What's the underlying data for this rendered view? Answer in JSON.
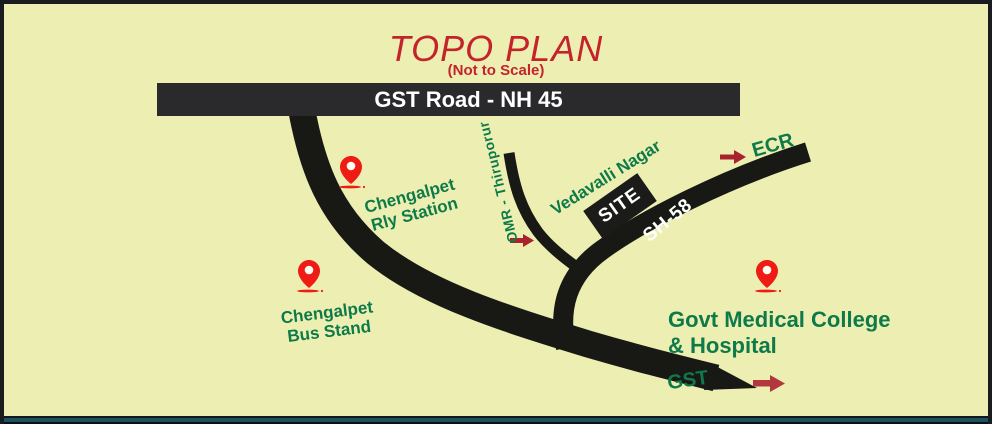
{
  "map": {
    "title": "TOPO PLAN",
    "subtitle": "(Not to Scale)",
    "gst_road_label": "GST Road - NH 45",
    "sh58_label": "SH-58",
    "omr_label": "OMR - Thiruporur",
    "vedavalli_label": "Vedavalli Nagar",
    "ecr_label": "ECR",
    "gst_exit_label": "GST",
    "site_label": "SITE",
    "rly_station": {
      "line1": "Chengalpet",
      "line2": "Rly Station"
    },
    "bus_stand": {
      "line1": "Chengalpet",
      "line2": "Bus Stand"
    },
    "medical_college": {
      "line1": "Govt Medical College",
      "line2": "& Hospital"
    }
  },
  "icons": {
    "pins": [
      "rly-station-pin",
      "bus-stand-pin",
      "medical-college-pin"
    ],
    "arrows": [
      "omr-direction-arrow",
      "ecr-direction-arrow",
      "gst-direction-arrow"
    ]
  },
  "colors": {
    "background": "#EDEFB2",
    "road": "#181815",
    "road_bar": "#2A2A2C",
    "label_green": "#0E7A49",
    "title_red": "#C4232B",
    "pin_red": "#EE1C15",
    "arrow_dark_red": "#A8232E",
    "arrow_crimson": "#B23840",
    "border_teal": "#1C525C"
  }
}
